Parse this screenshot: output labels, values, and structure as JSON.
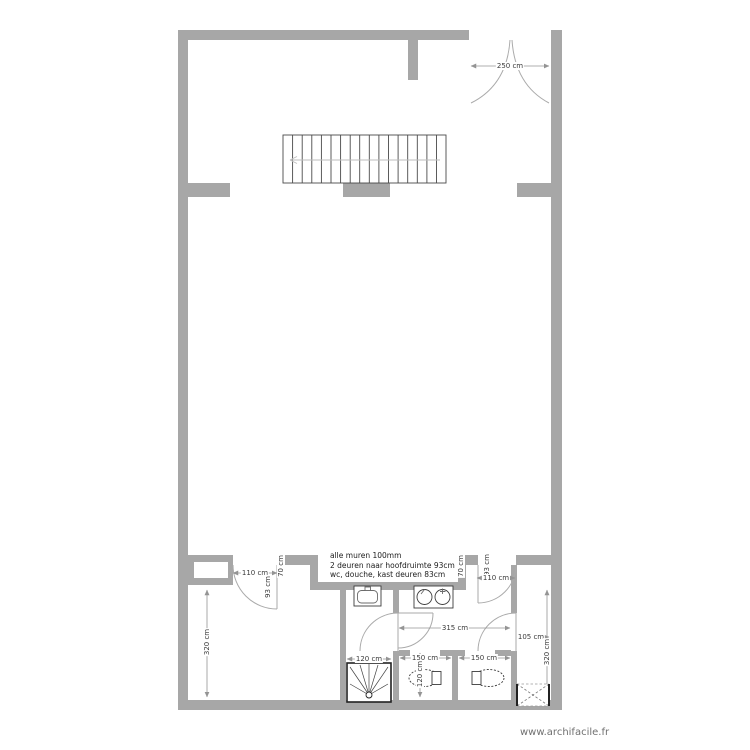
{
  "page": {
    "watermark": "www.archifacile.fr"
  },
  "notes": {
    "line1": "alle muren 100mm",
    "line2": "2 deuren naar hoofdruimte 93cm",
    "line3": "wc, douche, kast deuren 83cm"
  },
  "dimensions": {
    "entry_door": "250 cm",
    "left_door_opening": "110 cm",
    "left_door_leaf": "93 cm",
    "left_wall_segment": "70 cm",
    "right_wall_segment": "70 cm",
    "right_door_opening": "110 cm",
    "right_door_leaf": "93 cm",
    "left_room_depth": "320 cm",
    "right_room_depth": "320 cm",
    "hall_width": "315 cm",
    "right_room_width": "105 cm",
    "shower_width": "120 cm",
    "wc_left_width": "150 cm",
    "wc_left_depth": "120 cm",
    "wc_right_width": "150 cm"
  },
  "fixtures": {
    "staircase": "staircase-icon",
    "shower": "shower-tray-icon",
    "washbasin": "washbasin-icon",
    "double_washbasin": "double-washbasin-icon",
    "toilet_left": "toilet-icon",
    "toilet_right": "toilet-icon",
    "closet_void": "crossed-box-icon"
  },
  "colors": {
    "wall": "#a7a7a7",
    "dimension": "#949494",
    "door": "#aaaaaa",
    "fixture": "#3c3c3c",
    "text": "#1c1c1c",
    "watermark": "#707070"
  }
}
